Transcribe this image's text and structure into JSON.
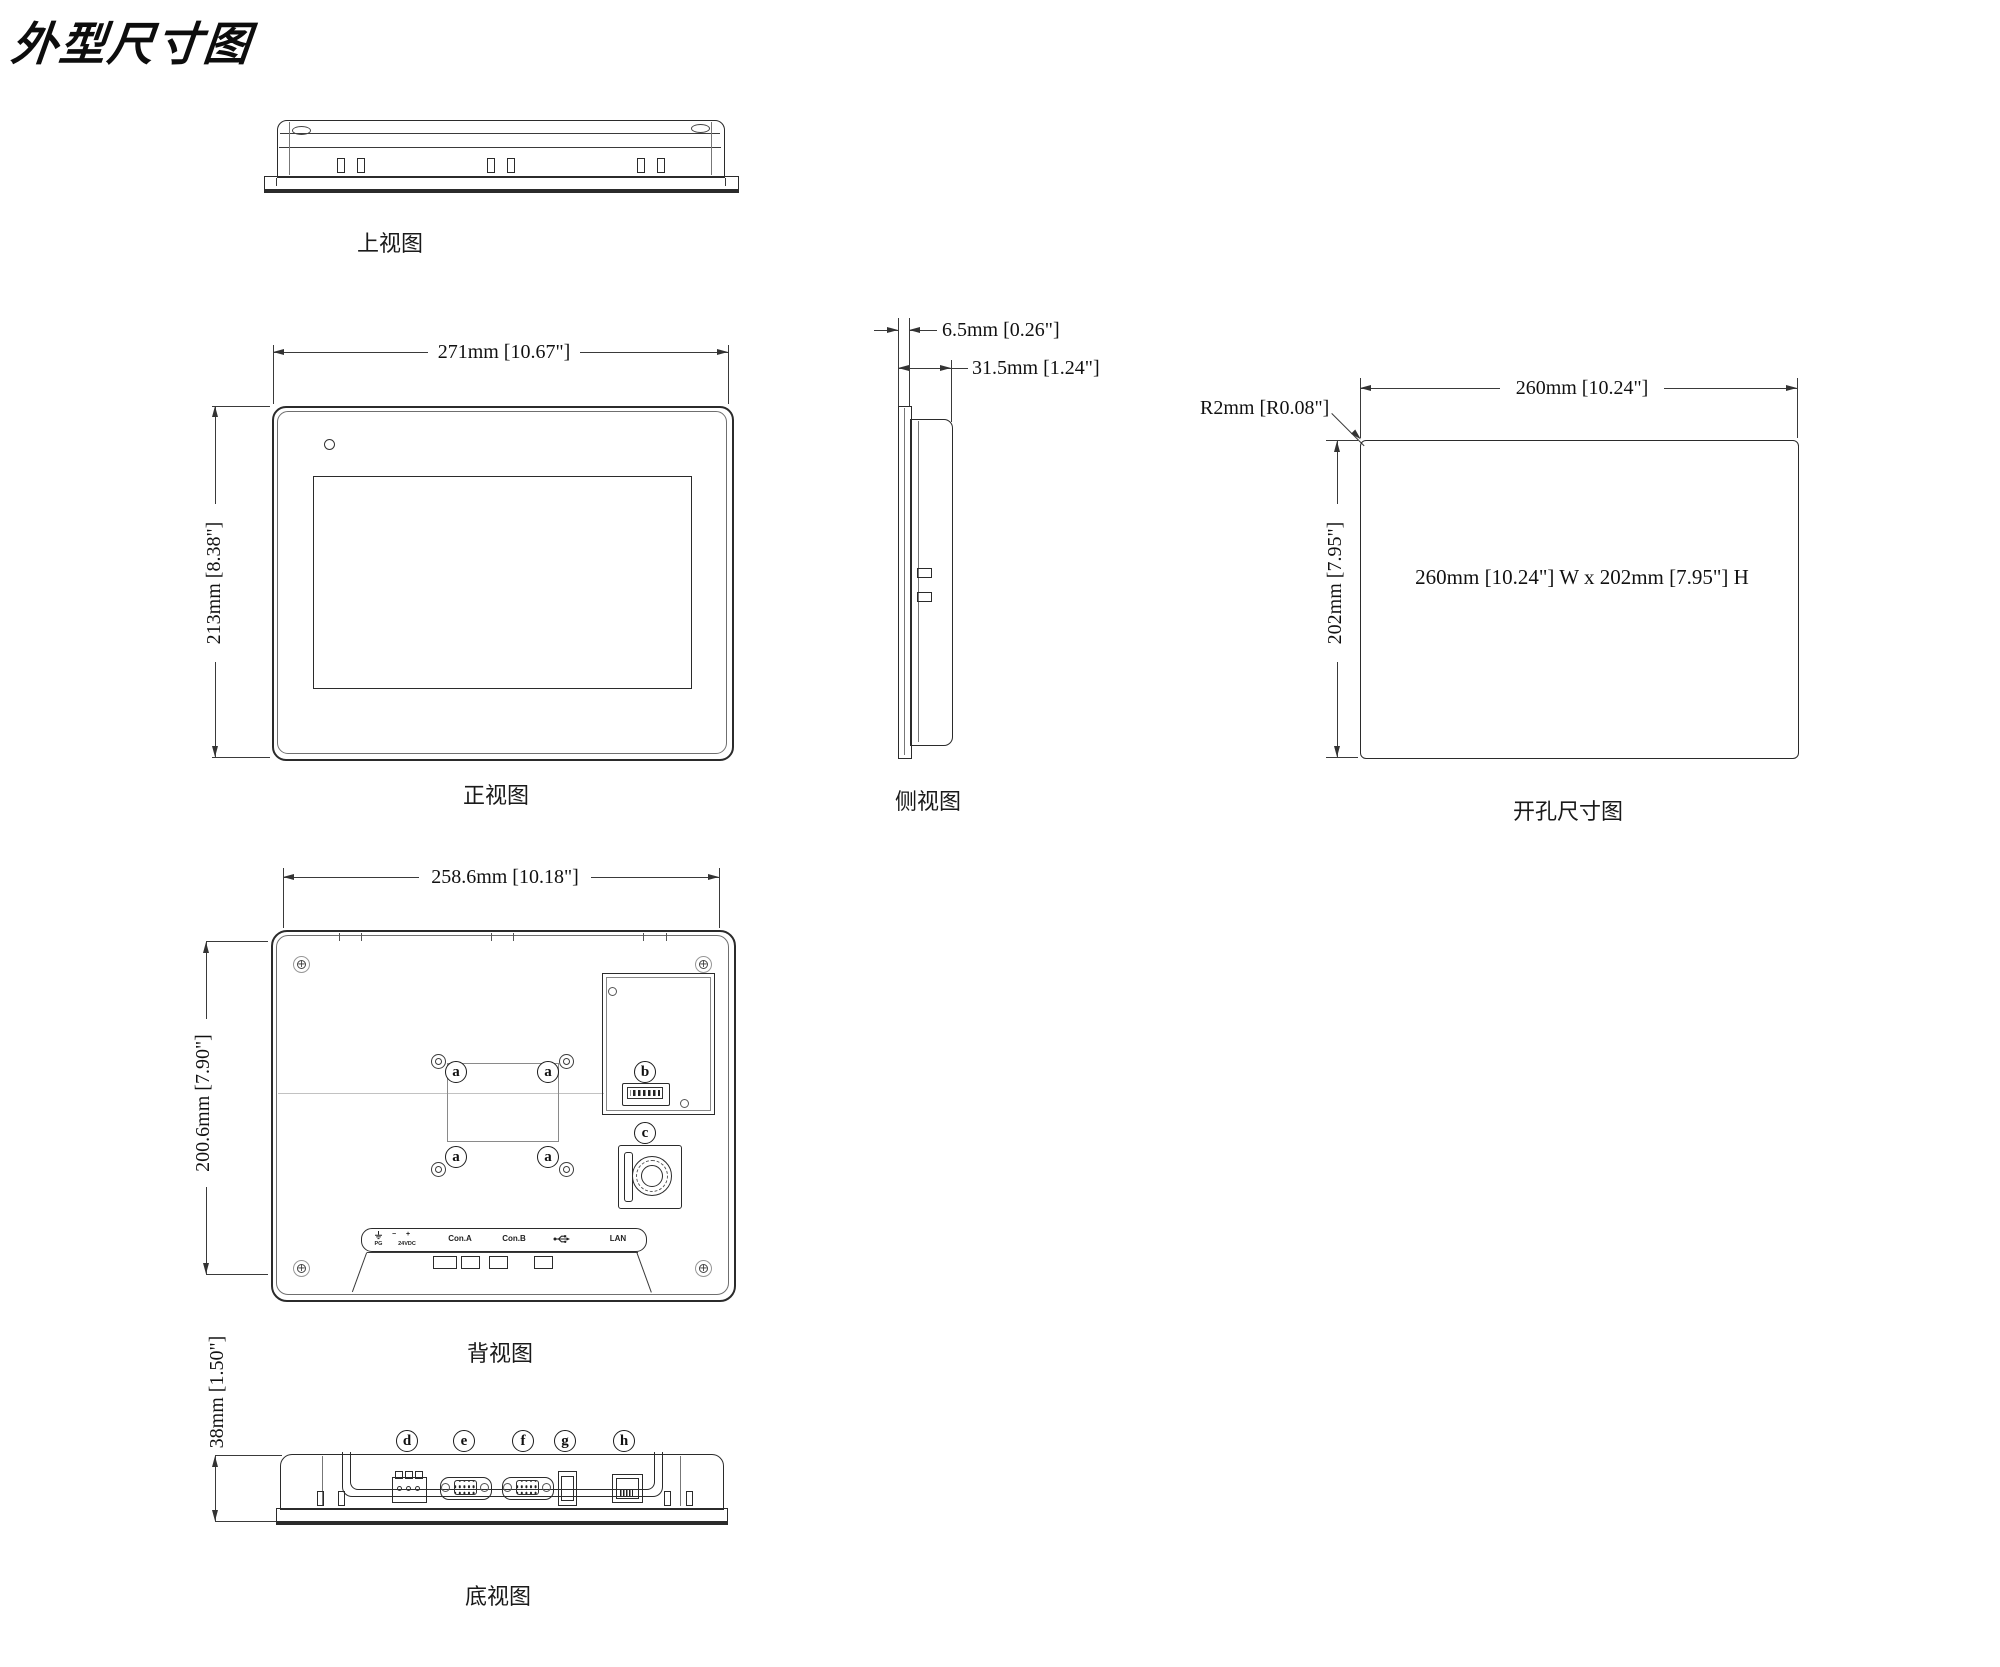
{
  "title": "外型尺寸图",
  "views": {
    "top": {
      "label": "上视图"
    },
    "front": {
      "label": "正视图",
      "dim_width": "271mm [10.67\"]",
      "dim_height": "213mm [8.38\"]"
    },
    "side": {
      "label": "侧视图",
      "dim_bezel": "6.5mm [0.26\"]",
      "dim_depth": "31.5mm [1.24\"]"
    },
    "cutout": {
      "label": "开孔尺寸图",
      "dim_width": "260mm [10.24\"]",
      "dim_height": "202mm [7.95\"]",
      "dim_radius": "R2mm [R0.08\"]",
      "note": "260mm [10.24\"] W x 202mm [7.95\"] H"
    },
    "back": {
      "label": "背视图",
      "dim_width": "258.6mm [10.18\"]",
      "dim_height": "200.6mm [7.90\"]",
      "callouts": {
        "a": "a",
        "b": "b",
        "c": "c"
      },
      "port_labels": {
        "pg": "PG",
        "minus": "−",
        "plus": "+",
        "vdc": "24VDC",
        "con_a": "Con.A",
        "con_b": "Con.B",
        "lan": "LAN"
      }
    },
    "bottom": {
      "label": "底视图",
      "dim_height": "38mm [1.50\"]",
      "callouts": {
        "d": "d",
        "e": "e",
        "f": "f",
        "g": "g",
        "h": "h"
      }
    }
  },
  "colors": {
    "line": "#2b2b2b",
    "dim_line": "#3a3a3a",
    "light": "#bdbdbd",
    "text": "#111111",
    "bg": "#ffffff"
  }
}
